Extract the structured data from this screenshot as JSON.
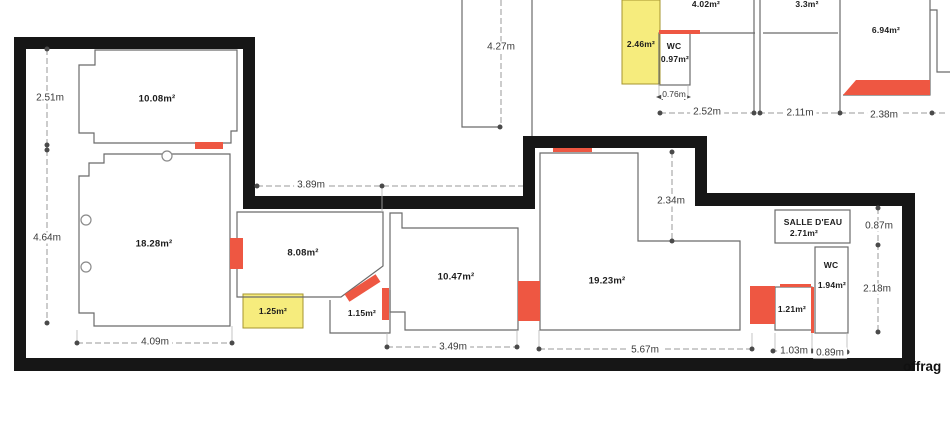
{
  "plan": {
    "rooms": {
      "room_10_08": "10.08m²",
      "room_18_28": "18.28m²",
      "room_8_08": "8.08m²",
      "room_1_25": "1.25m²",
      "room_1_15": "1.15m²",
      "room_10_47": "10.47m²",
      "room_19_23": "19.23m²",
      "salle_deau_name": "SALLE D'EAU",
      "salle_deau_area": "2.71m²",
      "wc_right_name": "WC",
      "wc_right_area": "1.94m²",
      "room_1_21": "1.21m²",
      "room_2_46": "2.46m²",
      "wc_top_name": "WC",
      "wc_top_area": "0.97m²",
      "room_4_02": "4.02m²",
      "room_3_3": "3.3m²",
      "room_6_94": "6.94m²"
    },
    "dimensions": {
      "left_upper": "2.51m",
      "left_lower": "4.64m",
      "bottom_left": "4.09m",
      "recess_width": "3.89m",
      "bottom_mid": "3.49m",
      "bottom_long": "5.67m",
      "bottom_1_03": "1.03m",
      "bottom_0_89": "0.89m",
      "mid_vertical": "2.34m",
      "right_upper": "0.87m",
      "right_lower": "2.18m",
      "top_vertical": "4.27m",
      "wc_width": "0.76m",
      "top_2_52": "2.52m",
      "top_2_11": "2.11m",
      "top_2_38": "2.38m"
    },
    "annotation": "offrag",
    "colors": {
      "wall": "#161616",
      "opening_red": "#ee5742",
      "highlight_yellow": "#f6ec7d",
      "linework": "#6b6b6b"
    }
  }
}
